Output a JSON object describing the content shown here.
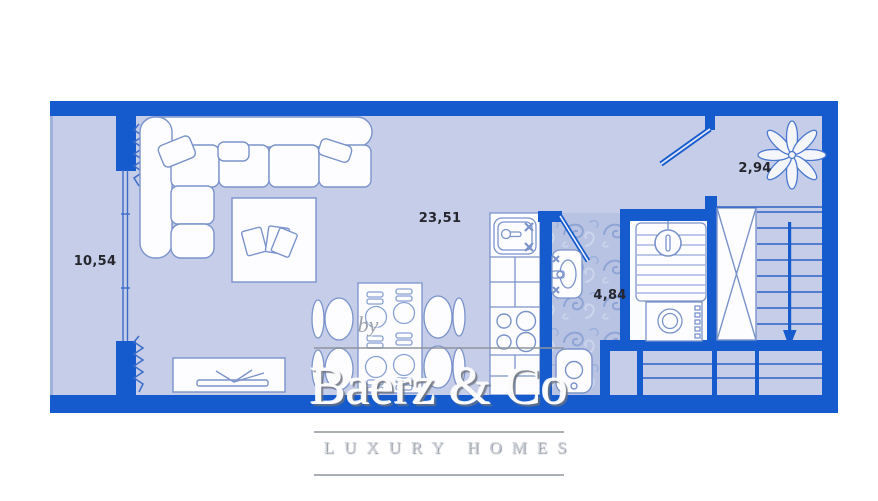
{
  "plan": {
    "type": "apartment-floor-plan",
    "rooms": [
      {
        "id": "balcony",
        "area_label": "10,54"
      },
      {
        "id": "living-room",
        "area_label": "23,51"
      },
      {
        "id": "bathroom",
        "area_label": "4,84"
      },
      {
        "id": "hallway",
        "area_label": "2,94"
      }
    ],
    "watermark": {
      "prefix": "by",
      "brand": "Baerz & Co",
      "tagline": "LUXURY HOMES"
    },
    "colors": {
      "wall": "#155bcd",
      "floor": "#c5cde8",
      "bath_tile": "#b8c3e3",
      "furniture_fill": "#fdfdff",
      "furniture_outline": "#7b93cb",
      "label_text": "#26262e",
      "background": "#ffffff"
    }
  }
}
